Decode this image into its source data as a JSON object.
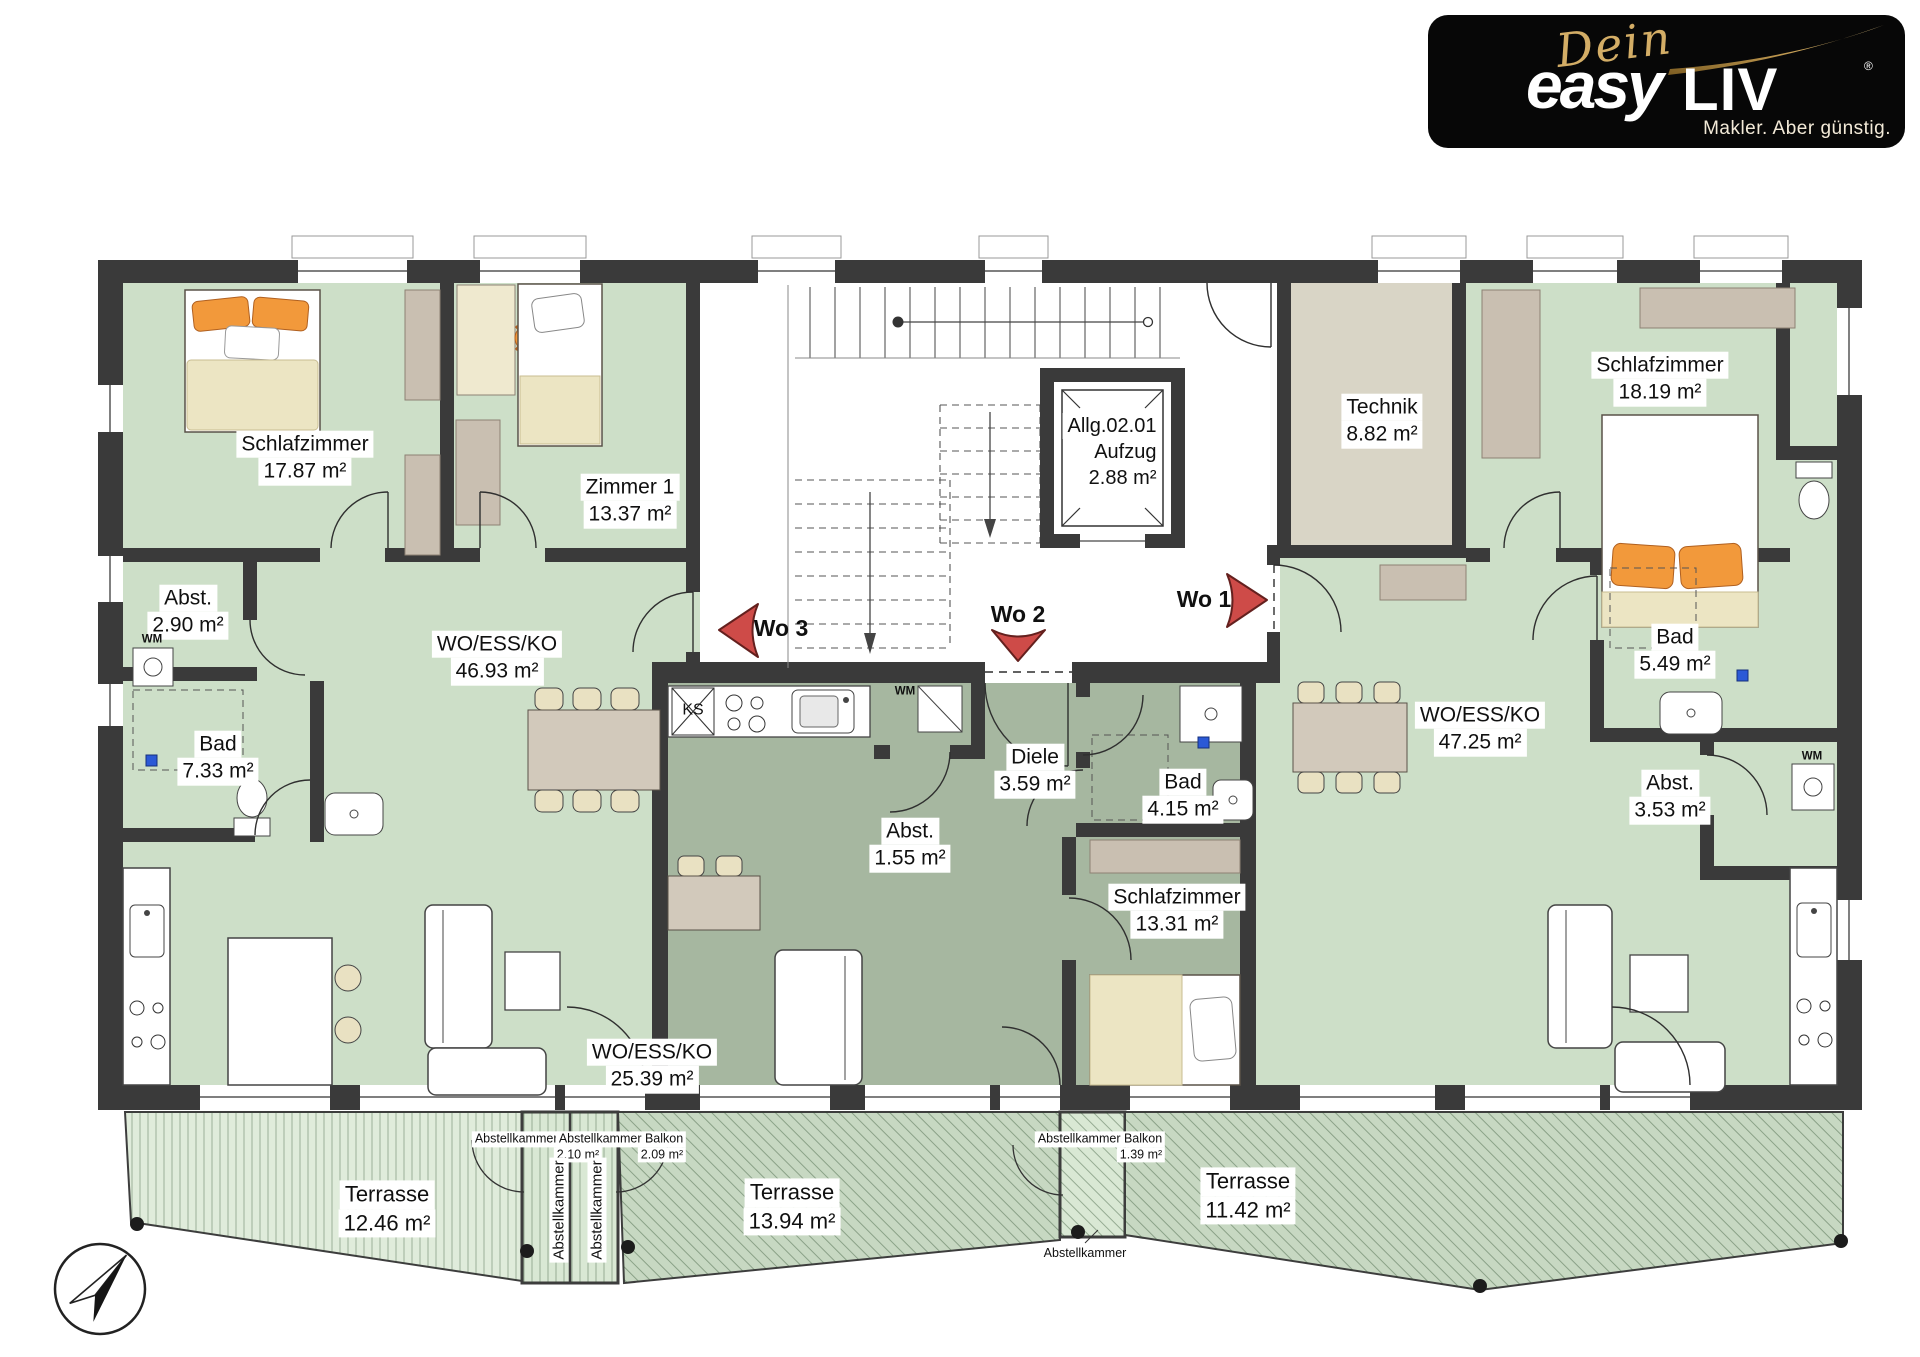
{
  "logo": {
    "script": "Dein",
    "brand_a": "easy",
    "brand_b": "LIV",
    "reg": "®",
    "tagline": "Makler. Aber günstig."
  },
  "units": {
    "wo1": "Wo 1",
    "wo2": "Wo 2",
    "wo3": "Wo 3"
  },
  "rooms": {
    "wo3_schlaf": {
      "name": "Schlafzimmer",
      "area": "17.87 m²"
    },
    "wo3_zimmer1": {
      "name": "Zimmer 1",
      "area": "13.37 m²"
    },
    "wo3_abst": {
      "name": "Abst.",
      "area": "2.90 m²"
    },
    "wo3_bad": {
      "name": "Bad",
      "area": "7.33 m²"
    },
    "wo3_wohnen": {
      "name": "WO/ESS/KO",
      "area": "46.93 m²"
    },
    "wo2_diele": {
      "name": "Diele",
      "area": "3.59 m²"
    },
    "wo2_abst": {
      "name": "Abst.",
      "area": "1.55 m²"
    },
    "wo2_bad": {
      "name": "Bad",
      "area": "4.15 m²"
    },
    "wo2_schlaf": {
      "name": "Schlafzimmer",
      "area": "13.31 m²"
    },
    "wo2_wohnen": {
      "name": "WO/ESS/KO",
      "area": "25.39 m²"
    },
    "wo1_schlaf": {
      "name": "Schlafzimmer",
      "area": "18.19 m²"
    },
    "wo1_bad": {
      "name": "Bad",
      "area": "5.49 m²"
    },
    "wo1_wohnen": {
      "name": "WO/ESS/KO",
      "area": "47.25 m²"
    },
    "wo1_abst": {
      "name": "Abst.",
      "area": "3.53 m²"
    },
    "technik": {
      "name": "Technik",
      "area": "8.82 m²"
    },
    "aufzug": {
      "line1": "Allg.02.01",
      "line2": "Aufzug",
      "line3": "2.88 m²"
    }
  },
  "terraces": {
    "left": {
      "name": "Terrasse",
      "area": "12.46 m²"
    },
    "middle": {
      "name": "Terrasse",
      "area": "13.94 m²"
    },
    "right": {
      "name": "Terrasse",
      "area": "11.42 m²"
    },
    "storage1": {
      "name": "Abstellkammer Balkon",
      "area": "2.10 m²"
    },
    "storage2": {
      "name": "Abstellkammer Balkon",
      "area": "2.09 m²"
    },
    "storage3": {
      "name": "Abstellkammer Balkon",
      "area": "1.39 m²"
    },
    "storage_room": "Abstellkammer"
  },
  "appliances": {
    "washer": "WM",
    "fridge": "KS"
  },
  "colors": {
    "apartment_light": "#cddfc8",
    "apartment_dark": "#a6b7a0",
    "technik_room": "#d9d5c6",
    "wall": "#3a3a3a",
    "entrance_arrow": "#ce4b48",
    "logo_gold": "#d3ad66"
  }
}
